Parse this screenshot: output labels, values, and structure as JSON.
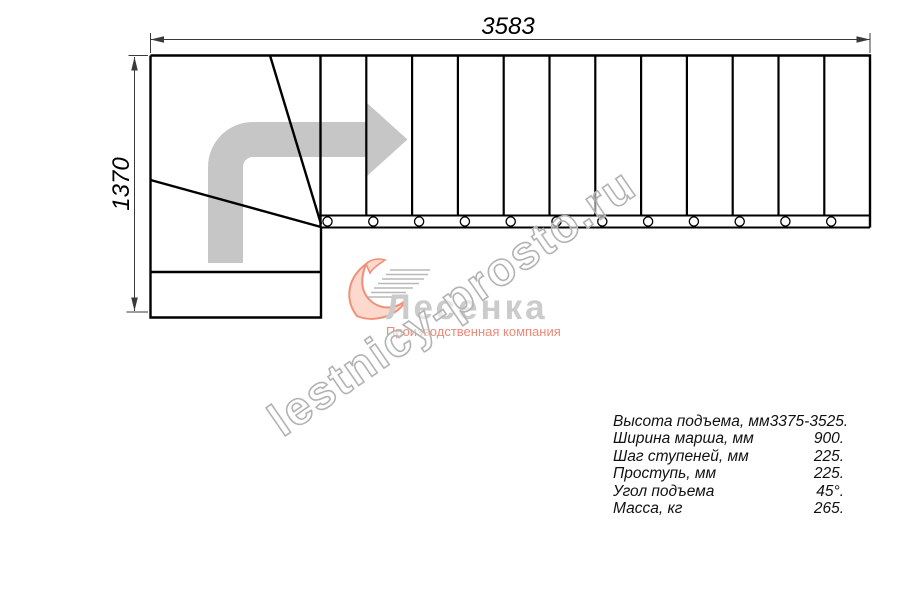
{
  "drawing": {
    "width_dim": "3583",
    "height_dim": "1370",
    "line_color": "#000000",
    "dim_color": "#3a3a3a",
    "arrow_color": "#c6c6c6"
  },
  "watermark": {
    "text": "lestnicy-prosto.ru",
    "outline_color": "#b3b3b3"
  },
  "logo": {
    "name": "Лесенка",
    "subtitle": "Производственная компания",
    "accent_color": "#f0907a",
    "name_color": "#cbcbcb"
  },
  "specs": {
    "rows": [
      {
        "label": "Высота подъема, мм",
        "value": "3375-3525."
      },
      {
        "label": "Ширина марша, мм",
        "value": "900."
      },
      {
        "label": "Шаг ступеней, мм",
        "value": "225."
      },
      {
        "label": "Проступь, мм",
        "value": "225."
      },
      {
        "label": "Угол подъема",
        "value": "45°."
      },
      {
        "label": "Масса, кг",
        "value": "265."
      }
    ]
  }
}
